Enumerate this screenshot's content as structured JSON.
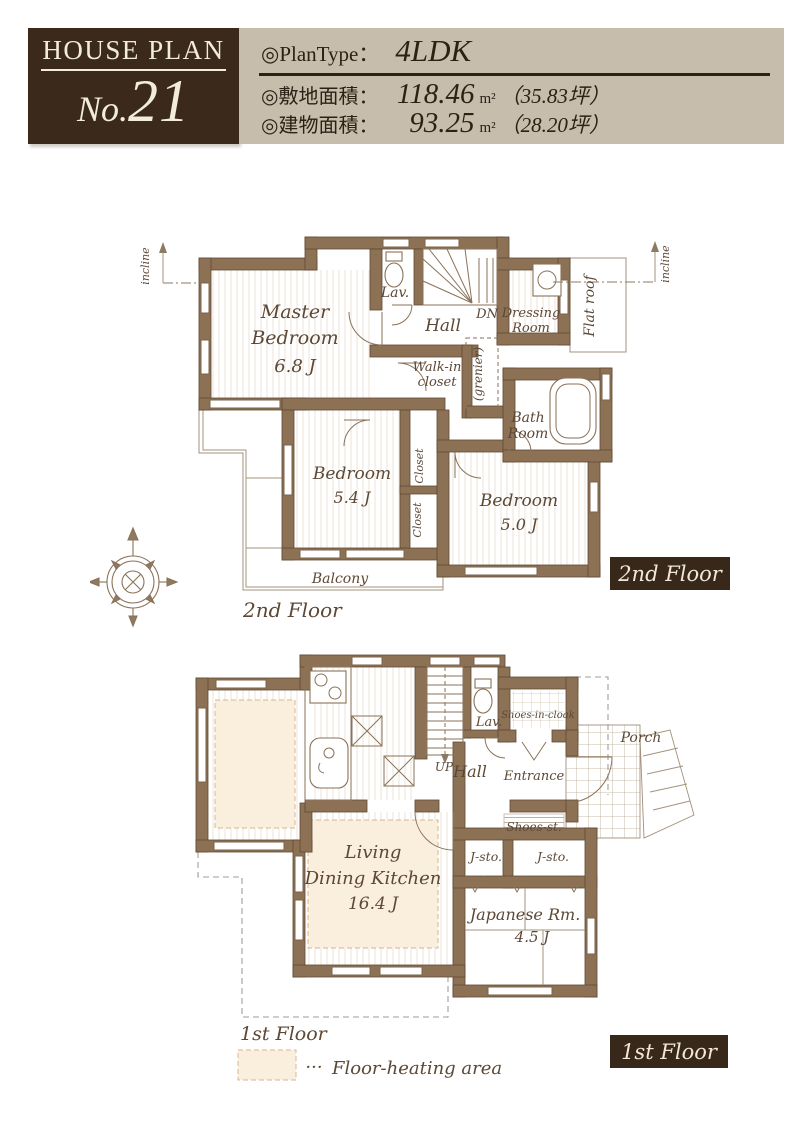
{
  "header": {
    "brand": {
      "title": "HOUSE PLAN",
      "no_prefix": "No.",
      "no_value": "21"
    },
    "info": {
      "plan_type_label": "◎PlanType：",
      "plan_type": "4LDK",
      "rows": [
        {
          "label": "◎敷地面積：",
          "value": "118.46",
          "unit": "m²",
          "tsubo": "（35.83坪）"
        },
        {
          "label": "◎建物面積：",
          "value": "93.25",
          "unit": "m²",
          "tsubo": "（28.20坪）"
        }
      ]
    }
  },
  "floors": {
    "second": {
      "caption": "2nd Floor",
      "badge": "2nd Floor",
      "rooms": {
        "master": {
          "line1": "Master",
          "line2": "Bedroom",
          "size": "6.8 J"
        },
        "bedroom54": {
          "name": "Bedroom",
          "size": "5.4 J"
        },
        "bedroom50": {
          "name": "Bedroom",
          "size": "5.0 J"
        }
      },
      "labels": {
        "lav": "Lav.",
        "hall": "Hall",
        "dn": "DN",
        "walk_in_line1": "Walk-in",
        "walk_in_line2": "closet",
        "grenier": "(grenier)",
        "dressing_line1": "Dressing",
        "dressing_line2": "Room",
        "flat_roof": "Flat roof",
        "bath_line1": "Bath",
        "bath_line2": "Room",
        "closet_upper": "Closet",
        "closet_lower": "Closet",
        "balcony": "Balcony",
        "incline_left": "incline",
        "incline_right": "incline"
      }
    },
    "first": {
      "caption": "1st Floor",
      "badge": "1st Floor",
      "rooms": {
        "ldk": {
          "line1": "Living",
          "line2": "Dining Kitchen",
          "size": "16.4 J"
        },
        "japanese": {
          "name": "Japanese Rm.",
          "size": "4.5 J"
        }
      },
      "labels": {
        "lav": "Lav.",
        "up": "UP",
        "hall": "Hall",
        "entrance": "Entrance",
        "shoes_in_cloak": "Shoes-in-cloak",
        "shoes_st": "Shoes-st.",
        "porch": "Porch",
        "j_sto_left": "J-sto.",
        "j_sto_right": "J-sto."
      }
    }
  },
  "legend": {
    "dots": "···",
    "label": "Floor-heating area"
  },
  "colors": {
    "header_brown": "#3b2a1c",
    "header_beige": "#c7bdad",
    "wall": "#8d7154",
    "label_text": "#5c4836",
    "floor_heating": "#faeedd",
    "badge_text": "#f1e8d8"
  }
}
